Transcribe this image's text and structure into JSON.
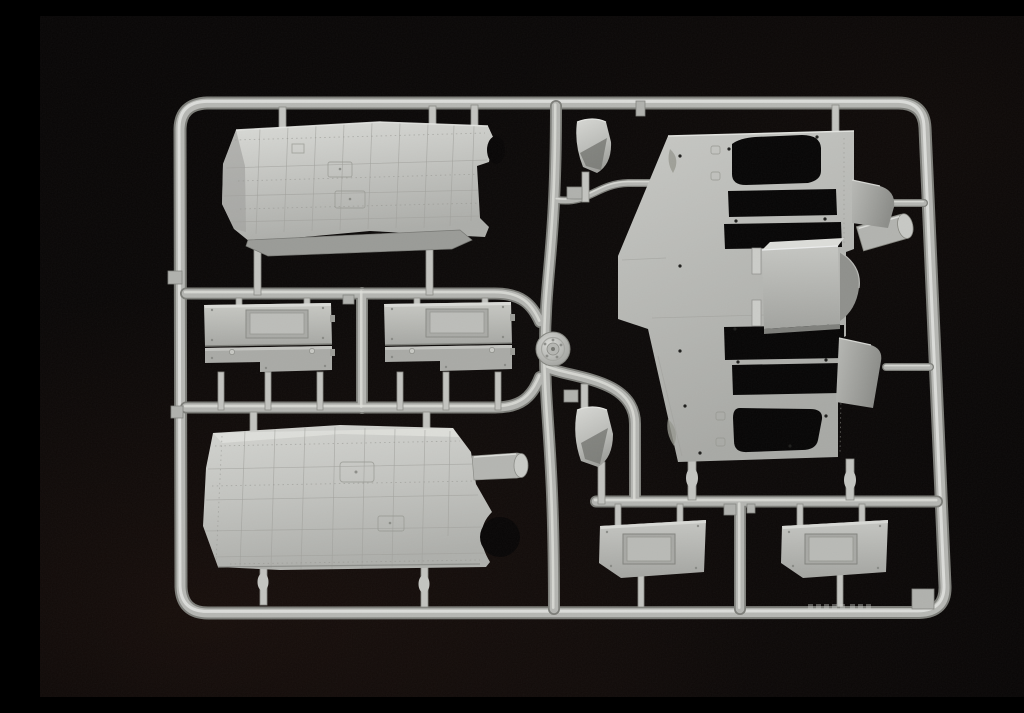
{
  "scene": {
    "description": "Photograph of a light grey injection-moulded plastic model kit sprue (parts tree) on a black background. The rounded runner frame holds large engraved hull panels, a flat chassis plate with cut-out openings, rectangular hatch panels with recessed lids, small curved fender flaps, a round bolt-detailed cap and cylindrical stubs, all attached by moulding gates.",
    "colors": {
      "bg": "#070505",
      "plastic": "#c2c3bf",
      "plastic-light": "#dfe0dc",
      "plastic-mid": "#b6b7b3",
      "plastic-dark": "#8d8e8a",
      "plastic-shadow": "#777874",
      "cutout": "#060505"
    }
  },
  "sprue": {
    "material": "light grey styrene",
    "parts": [
      {
        "id": "outer-frame",
        "label": "outer runner frame with rounded corners"
      },
      {
        "id": "upper-roof-panel",
        "label": "large curved roof panel with engraved plating grid"
      },
      {
        "id": "hatch-panel-1",
        "label": "rectangular hatch panel with recessed lid (left)"
      },
      {
        "id": "hatch-panel-2",
        "label": "rectangular hatch panel with recessed lid (right)"
      },
      {
        "id": "lower-side-panel",
        "label": "large curved side panel with pipe stub"
      },
      {
        "id": "chassis-plate",
        "label": "flat chassis plate with cut-out openings and rivet holes"
      },
      {
        "id": "box-housing",
        "label": "rectangular box housing seated on the chassis plate"
      },
      {
        "id": "exhaust-stub",
        "label": "cylindrical stub on chassis right edge"
      },
      {
        "id": "fender-flap-1",
        "label": "small curved fender flap (upper middle)"
      },
      {
        "id": "fender-flap-2",
        "label": "small curved fender flap (lower middle)"
      },
      {
        "id": "round-cap",
        "label": "round cap part with bolt-head hub detail"
      },
      {
        "id": "side-flap-1",
        "label": "angled side flap (upper right)"
      },
      {
        "id": "side-flap-2",
        "label": "angled side flap (lower right)"
      },
      {
        "id": "rear-hatch-1",
        "label": "trapezoid hatch panel with recessed lid (bottom left of pair)"
      },
      {
        "id": "rear-hatch-2",
        "label": "trapezoid hatch panel with recessed lid (bottom right of pair)"
      }
    ],
    "embossed_marking": {
      "location": "bottom rail, right of centre",
      "legible": false
    }
  }
}
